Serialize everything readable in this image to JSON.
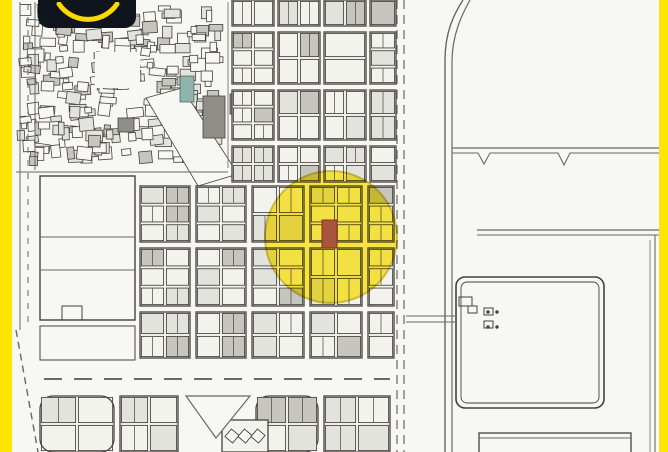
{
  "branding": {
    "logo_text": "SAKAN",
    "logo_bg": "#10141d",
    "logo_accent": "#ffd800"
  },
  "frame": {
    "border_color": "#ffe600"
  },
  "map": {
    "seed": 20,
    "bg": "#f7f7f3",
    "block_bg": "#f3f3ee",
    "ink": "#44423c",
    "ink_light": "#6a6862",
    "fill_light": "#e3e3dd",
    "fill_mid": "#c6c6bf",
    "highlight": {
      "cx": 331,
      "cy": 237,
      "r": 66,
      "color": "#ffe400",
      "opacity": 0.72,
      "stroke": "#b29a00"
    },
    "marker": {
      "x": 322,
      "y": 220,
      "w": 15,
      "h": 28,
      "color": "#a8543e",
      "stroke": "#7e3526"
    },
    "dense": {
      "x": 16,
      "y": 2,
      "w": 210,
      "h": 164,
      "count": 240,
      "min": 5,
      "max": 17
    },
    "patches": [
      {
        "x": 95,
        "y": 52,
        "w": 45,
        "h": 36,
        "f": "bg"
      },
      {
        "d": "M146,98 L182,88 L238,174 L198,186 Z",
        "f": "bg",
        "sw": 0.8
      },
      {
        "x": 203,
        "y": 96,
        "w": 22,
        "h": 42,
        "f": "#8f8f88",
        "sw": 0.8
      },
      {
        "x": 230,
        "y": 94,
        "w": 24,
        "h": 20,
        "f": "#8f8f88",
        "sw": 0.8
      },
      {
        "x": 118,
        "y": 118,
        "w": 16,
        "h": 14,
        "f": "#8f8f88",
        "sw": 0.8
      },
      {
        "x": 180,
        "y": 76,
        "w": 14,
        "h": 26,
        "f": "#8fb3ad",
        "sw": 0.6
      }
    ],
    "blocks": [
      [
        232,
        0,
        42,
        26,
        2,
        1
      ],
      [
        278,
        0,
        42,
        26,
        2,
        1
      ],
      [
        324,
        0,
        42,
        26,
        2,
        1
      ],
      [
        370,
        0,
        26,
        26,
        1,
        1
      ],
      [
        232,
        32,
        42,
        52,
        2,
        3
      ],
      [
        278,
        32,
        42,
        52,
        2,
        2
      ],
      [
        324,
        32,
        42,
        52,
        1,
        2
      ],
      [
        370,
        32,
        26,
        52,
        1,
        3
      ],
      [
        232,
        90,
        42,
        50,
        2,
        3
      ],
      [
        278,
        90,
        42,
        50,
        2,
        2
      ],
      [
        324,
        90,
        42,
        50,
        2,
        2
      ],
      [
        370,
        90,
        26,
        50,
        1,
        2
      ],
      [
        232,
        146,
        42,
        36,
        2,
        2
      ],
      [
        278,
        146,
        42,
        36,
        2,
        2
      ],
      [
        324,
        146,
        42,
        36,
        2,
        2
      ],
      [
        370,
        146,
        26,
        36,
        1,
        2
      ],
      [
        140,
        186,
        50,
        56,
        2,
        3
      ],
      [
        196,
        186,
        50,
        56,
        2,
        3
      ],
      [
        252,
        186,
        52,
        56,
        2,
        2
      ],
      [
        310,
        186,
        52,
        56,
        2,
        3
      ],
      [
        368,
        186,
        26,
        56,
        1,
        3
      ],
      [
        140,
        248,
        50,
        58,
        2,
        3
      ],
      [
        196,
        248,
        50,
        58,
        2,
        3
      ],
      [
        252,
        248,
        52,
        58,
        2,
        3
      ],
      [
        310,
        248,
        52,
        58,
        2,
        2
      ],
      [
        368,
        248,
        26,
        58,
        1,
        3
      ],
      [
        140,
        312,
        50,
        46,
        2,
        2
      ],
      [
        196,
        312,
        50,
        46,
        2,
        2
      ],
      [
        252,
        312,
        52,
        46,
        2,
        2
      ],
      [
        310,
        312,
        52,
        46,
        2,
        2
      ],
      [
        368,
        312,
        26,
        46,
        1,
        2
      ],
      [
        40,
        396,
        74,
        56,
        2,
        2,
        "round"
      ],
      [
        120,
        396,
        58,
        56,
        2,
        2
      ],
      [
        256,
        396,
        62,
        56,
        2,
        2,
        "round"
      ],
      [
        324,
        396,
        66,
        56,
        2,
        2
      ],
      [
        222,
        420,
        46,
        32,
        2,
        1,
        "diag"
      ]
    ],
    "rects": [
      {
        "x": 40,
        "y": 176,
        "w": 95,
        "h": 144,
        "sw": 1.4
      },
      {
        "x": 40,
        "y": 326,
        "w": 95,
        "h": 34,
        "sw": 1.0
      },
      {
        "x": 62,
        "y": 306,
        "w": 20,
        "h": 14,
        "sw": 1.0
      },
      {
        "x": 456,
        "y": 277,
        "w": 148,
        "h": 131,
        "rx": 9,
        "sw": 1.6
      },
      {
        "x": 461,
        "y": 282,
        "w": 138,
        "h": 121,
        "rx": 6,
        "sw": 0.9
      },
      {
        "x": 479,
        "y": 433,
        "w": 152,
        "h": 26,
        "sw": 1.3
      },
      {
        "x": 459,
        "y": 297,
        "w": 13,
        "h": 9,
        "sw": 1.0
      },
      {
        "x": 468,
        "y": 306,
        "w": 9,
        "h": 7,
        "sw": 1.0
      },
      {
        "x": 484,
        "y": 308,
        "w": 9,
        "h": 7,
        "sw": 1.0
      },
      {
        "x": 484,
        "y": 321,
        "w": 9,
        "h": 7,
        "sw": 1.0
      }
    ],
    "lines": [
      [
        20,
        2,
        20,
        330,
        1.0
      ],
      [
        35,
        2,
        35,
        170,
        1.0
      ],
      [
        16,
        172,
        228,
        172,
        1.0
      ],
      [
        228,
        2,
        228,
        168,
        0.8
      ],
      [
        452,
        148,
        659,
        148,
        1.2
      ],
      [
        477,
        230,
        659,
        230,
        1.2
      ],
      [
        477,
        235,
        659,
        235,
        0.9
      ],
      [
        655,
        235,
        655,
        452,
        1.1
      ],
      [
        650,
        240,
        650,
        452,
        0.8
      ],
      [
        406,
        316,
        456,
        316,
        1.1
      ],
      [
        406,
        322,
        456,
        322,
        1.1
      ],
      [
        479,
        438,
        631,
        438,
        0.9
      ],
      [
        40,
        237,
        135,
        237,
        1.0
      ],
      [
        40,
        270,
        135,
        270,
        1.0
      ]
    ],
    "dashed": [
      [
        28,
        4,
        28,
        326,
        "6 7",
        1.0
      ],
      [
        397,
        0,
        397,
        452,
        "9 6",
        1.2
      ],
      [
        404,
        0,
        404,
        452,
        "9 6",
        1.2
      ],
      [
        16,
        330,
        38,
        452,
        "7 5",
        1.4
      ],
      [
        44,
        379,
        390,
        379,
        "18 12",
        2.0
      ]
    ],
    "paths": [
      {
        "d": "M463,0 C454,14 445,32 445,60 L445,452",
        "w": 1.4
      },
      {
        "d": "M470,0 C461,16 452,36 452,62 L452,452",
        "w": 1.2
      },
      {
        "d": "M452,153 L478,153 L484,164 L490,153 L558,153 L564,165 L570,153 L659,153",
        "w": 1.1
      },
      {
        "d": "M186,396 L250,396 L216,438 Z",
        "w": 1.2,
        "f": "bg"
      }
    ],
    "dots": [
      [
        488,
        312
      ],
      [
        497,
        312
      ],
      [
        488,
        327
      ],
      [
        497,
        327
      ]
    ]
  }
}
